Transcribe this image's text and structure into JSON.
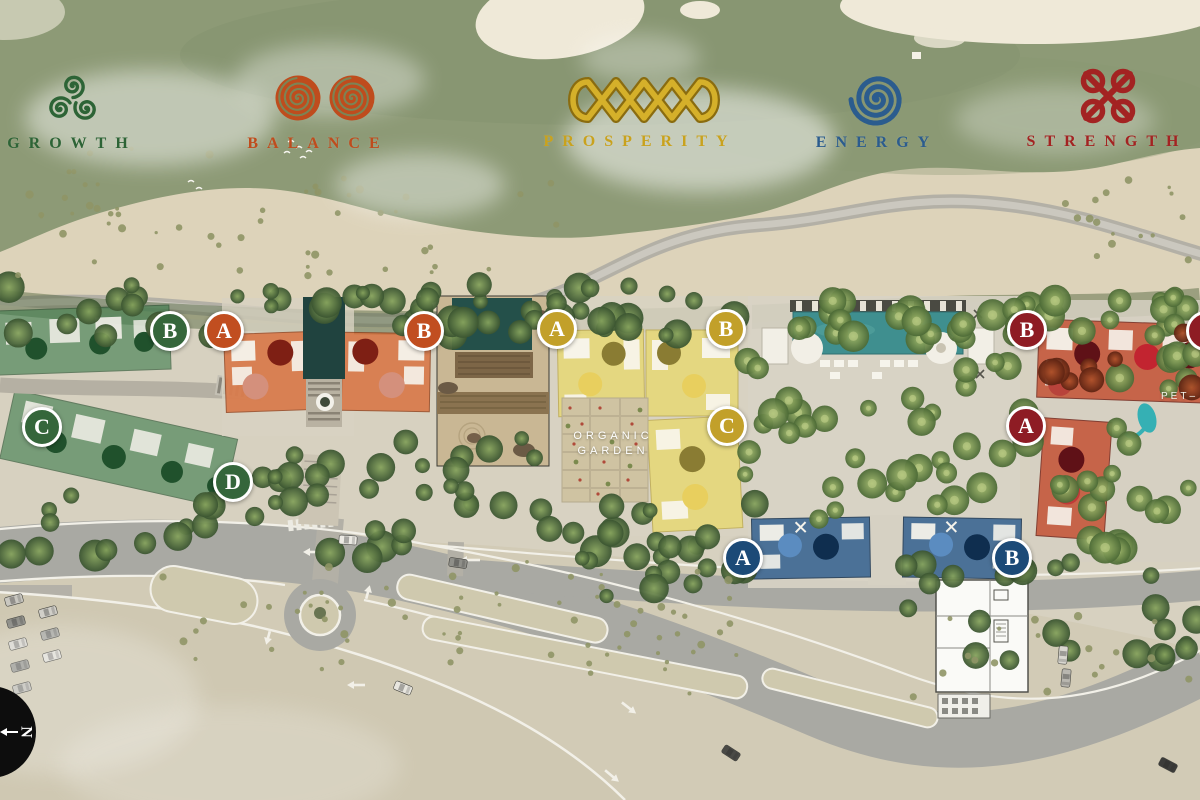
{
  "legend": {
    "themes": [
      {
        "name": "GROWTH",
        "symbol": "triskelion-icon",
        "color": "#2d6436"
      },
      {
        "name": "BALANCE",
        "symbol": "double-spiral-icon",
        "color": "#bf4c1d"
      },
      {
        "name": "PROSPERITY",
        "symbol": "celtic-braid-icon",
        "color": "#c9a21d"
      },
      {
        "name": "ENERGY",
        "symbol": "spiral-icon",
        "color": "#2b5c8e"
      },
      {
        "name": "STRENGTH",
        "symbol": "celtic-knot-icon",
        "color": "#a32322"
      }
    ]
  },
  "building_markers": [
    {
      "zone": "growth",
      "letter": "B"
    },
    {
      "zone": "balance",
      "letter": "A"
    },
    {
      "zone": "balance",
      "letter": "B"
    },
    {
      "zone": "growth",
      "letter": "C"
    },
    {
      "zone": "growth",
      "letter": "D"
    },
    {
      "zone": "prosperity",
      "letter": "A"
    },
    {
      "zone": "prosperity",
      "letter": "B"
    },
    {
      "zone": "prosperity",
      "letter": "C"
    },
    {
      "zone": "energy",
      "letter": "A"
    },
    {
      "zone": "energy",
      "letter": "B"
    },
    {
      "zone": "strength",
      "letter": "B"
    },
    {
      "zone": "strength",
      "letter": "A"
    },
    {
      "zone": "strength",
      "letter": ""
    }
  ],
  "labels": {
    "organic_garden": [
      "ORGANIC",
      "GARDEN"
    ],
    "pet_area": "PET–"
  },
  "compass": {
    "cardinal": "N"
  }
}
